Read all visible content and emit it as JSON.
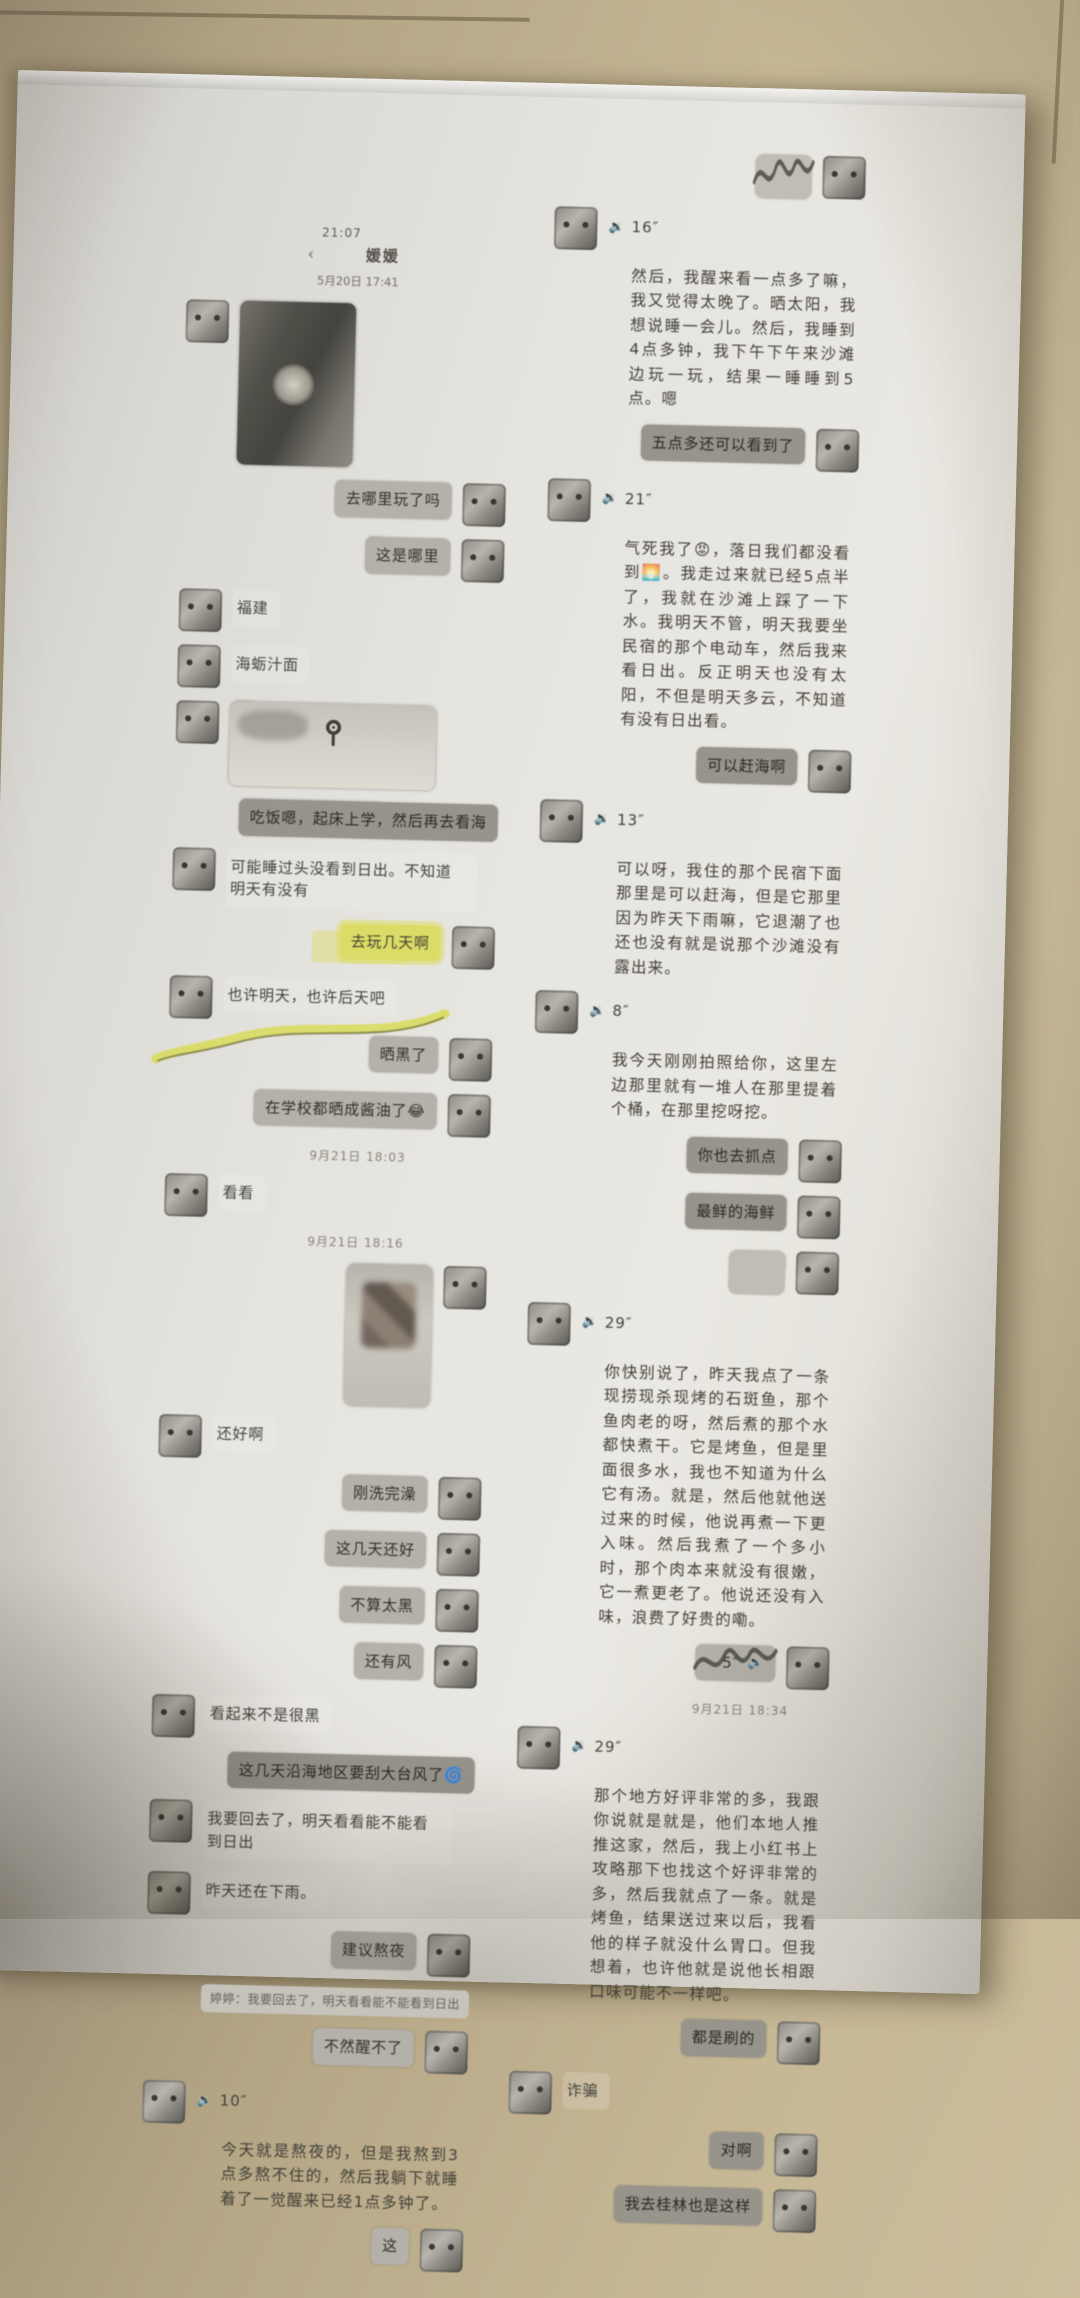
{
  "colors": {
    "tile": "#c6b795",
    "paper": "#e6e4df",
    "ink": "#38372f",
    "sent_bubble": "#b5b4ae",
    "sent_bubble_dark": "#95948d",
    "highlight_marker": "#e2e55f"
  },
  "icons": {
    "voice": "🔉",
    "back": "‹"
  },
  "left_chat": {
    "status_time": "21:07",
    "title": "媛媛",
    "date_divider": "5月20日 17:41",
    "messages": [
      {
        "kind": "photo",
        "side": "left",
        "photo": "dark-photo"
      },
      {
        "kind": "text",
        "side": "right",
        "text": "去哪里玩了吗"
      },
      {
        "kind": "text",
        "side": "right",
        "text": "这是哪里"
      },
      {
        "kind": "text",
        "side": "left",
        "text": "福建"
      },
      {
        "kind": "text",
        "side": "left",
        "text": "海蛎汁面"
      },
      {
        "kind": "map",
        "side": "left"
      },
      {
        "kind": "text",
        "side": "right",
        "dark": true,
        "wide": true,
        "text": "吃饭嗯，起床上学，然后再去看海"
      },
      {
        "kind": "text",
        "side": "left",
        "text": "可能睡过头没看到日出。不知道明天有没有"
      },
      {
        "kind": "text",
        "side": "right",
        "highlight": true,
        "text": "去玩几天啊"
      },
      {
        "kind": "text",
        "side": "left",
        "underline": true,
        "text": "也许明天，也许后天吧"
      },
      {
        "kind": "text",
        "side": "right",
        "text": "晒黑了"
      },
      {
        "kind": "text",
        "side": "right",
        "text": "在学校都晒成酱油了😂"
      },
      {
        "kind": "timestamp",
        "text": "9月21日 18:03"
      },
      {
        "kind": "text",
        "side": "left",
        "text": "看看"
      },
      {
        "kind": "timestamp",
        "text": "9月21日 18:16"
      },
      {
        "kind": "photo",
        "side": "right",
        "photo": "selfie-photo"
      },
      {
        "kind": "text",
        "side": "left",
        "text": "还好啊"
      },
      {
        "kind": "text",
        "side": "right",
        "text": "刚洗完澡"
      },
      {
        "kind": "text",
        "side": "right",
        "text": "这几天还好"
      },
      {
        "kind": "text",
        "side": "right",
        "text": "不算太黑"
      },
      {
        "kind": "text",
        "side": "right",
        "text": "还有风"
      },
      {
        "kind": "text",
        "side": "left",
        "text": "看起来不是很黑"
      },
      {
        "kind": "text",
        "side": "right",
        "dark": true,
        "wide": true,
        "text": "这几天沿海地区要刮大台风了🌀"
      },
      {
        "kind": "text",
        "side": "left",
        "text": "我要回去了，明天看看能不能看到日出"
      },
      {
        "kind": "text",
        "side": "left",
        "text": "昨天还在下雨。"
      },
      {
        "kind": "text",
        "side": "right",
        "text": "建议熬夜"
      },
      {
        "kind": "quote",
        "text": "婷婷：我要回去了，明天看看能不能看到日出"
      },
      {
        "kind": "text",
        "side": "right",
        "text": "不然醒不了"
      },
      {
        "kind": "voice",
        "side": "left",
        "duration": "10″"
      },
      {
        "kind": "transcript",
        "text": "今天就是熬夜的，但是我熬到3点多熬不住的，然后我躺下就睡着了一觉醒来已经1点多钟了。"
      },
      {
        "kind": "text",
        "side": "right",
        "text": "这"
      }
    ]
  },
  "right_chat": {
    "messages": [
      {
        "kind": "sticker",
        "side": "right",
        "scribble": true
      },
      {
        "kind": "voice",
        "side": "left",
        "duration": "16″"
      },
      {
        "kind": "transcript",
        "text": "然后，我醒来看一点多了嘛，我又觉得太晚了。晒太阳，我想说睡一会儿。然后，我睡到4点多钟，我下午下午来沙滩边玩一玩，结果一睡睡到5点。嗯"
      },
      {
        "kind": "text",
        "side": "right",
        "dark": true,
        "text": "五点多还可以看到了"
      },
      {
        "kind": "voice",
        "side": "left",
        "duration": "21″"
      },
      {
        "kind": "transcript",
        "text": "气死我了😡，落日我们都没看到🌅。我走过来就已经5点半了，我就在沙滩上踩了一下水。我明天不管，明天我要坐民宿的那个电动车，然后我来看日出。反正明天也没有太阳，不但是明天多云，不知道有没有日出看。"
      },
      {
        "kind": "text",
        "side": "right",
        "dark": true,
        "text": "可以赶海啊"
      },
      {
        "kind": "voice",
        "side": "left",
        "duration": "13″"
      },
      {
        "kind": "transcript",
        "text": "可以呀，我住的那个民宿下面那里是可以赶海，但是它那里因为昨天下雨嘛，它退潮了也还也没有就是说那个沙滩没有露出来。"
      },
      {
        "kind": "voice",
        "side": "left",
        "duration": "8″"
      },
      {
        "kind": "transcript",
        "text": "我今天刚刚拍照给你，这里左边那里就有一堆人在那里提着个桶，在那里挖呀挖。"
      },
      {
        "kind": "text",
        "side": "right",
        "dark": true,
        "text": "你也去抓点"
      },
      {
        "kind": "text",
        "side": "right",
        "dark": true,
        "text": "最鲜的海鲜"
      },
      {
        "kind": "sticker",
        "side": "right"
      },
      {
        "kind": "voice",
        "side": "left",
        "duration": "29″"
      },
      {
        "kind": "transcript",
        "text": "你快别说了，昨天我点了一条现捞现杀现烤的石斑鱼，那个鱼肉老的呀，然后煮的那个水都快煮干。它是烤鱼，但是里面很多水，我也不知道为什么它有汤。就是，然后他就他送过来的时候，他说再煮一下更入味。然后我煮了一个多小时，那个肉本来就没有很嫩，它一煮更老了。他说还没有入味，浪费了好贵的嘞。"
      },
      {
        "kind": "voice",
        "side": "right",
        "duration": "5″",
        "scribble": true
      },
      {
        "kind": "timestamp",
        "text": "9月21日 18:34"
      },
      {
        "kind": "voice",
        "side": "left",
        "duration": "29″"
      },
      {
        "kind": "transcript",
        "text": "那个地方好评非常的多，我跟你说就是就是，他们本地人推推这家，然后，我上小红书上攻略那下也找这个好评非常的多，然后我就点了一条。就是烤鱼，结果送过来以后，我看他的样子就没什么胃口。但我想着，也许他就是说他长相跟口味可能不一样吧。"
      },
      {
        "kind": "text",
        "side": "right",
        "dark": true,
        "text": "都是刷的"
      },
      {
        "kind": "text",
        "side": "left",
        "text": "诈骗"
      },
      {
        "kind": "text",
        "side": "right",
        "dark": true,
        "text": "对啊"
      },
      {
        "kind": "text",
        "side": "right",
        "dark": true,
        "text": "我去桂林也是这样"
      }
    ]
  }
}
